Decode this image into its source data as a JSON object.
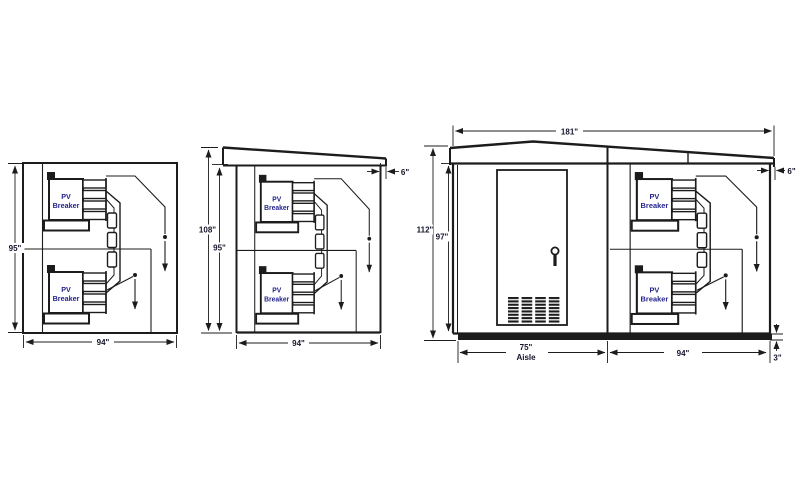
{
  "drawing": {
    "description": "PV switchgear walk-in enclosure dimensional drawing, three views",
    "colors": {
      "background": "#ffffff",
      "line": "#1c1c1c",
      "dimension_text": "#14142b",
      "breaker_text": "#23238c"
    },
    "breaker_label": {
      "line1": "PV",
      "line2": "Breaker"
    },
    "views": {
      "rear_section": {
        "height": "95\"",
        "width": "94\""
      },
      "side_elevation": {
        "overall_height": "108\"",
        "wall_height": "95\"",
        "depth": "94\"",
        "roof_overhang": "6\""
      },
      "front_elevation": {
        "overall_width": "181\"",
        "overall_height": "112\"",
        "wall_height": "97\"",
        "aisle_width": "75\"",
        "aisle_caption": "Aisle",
        "switchgear_depth": "94\"",
        "roof_overhang": "6\"",
        "base_height": "3\""
      }
    }
  }
}
